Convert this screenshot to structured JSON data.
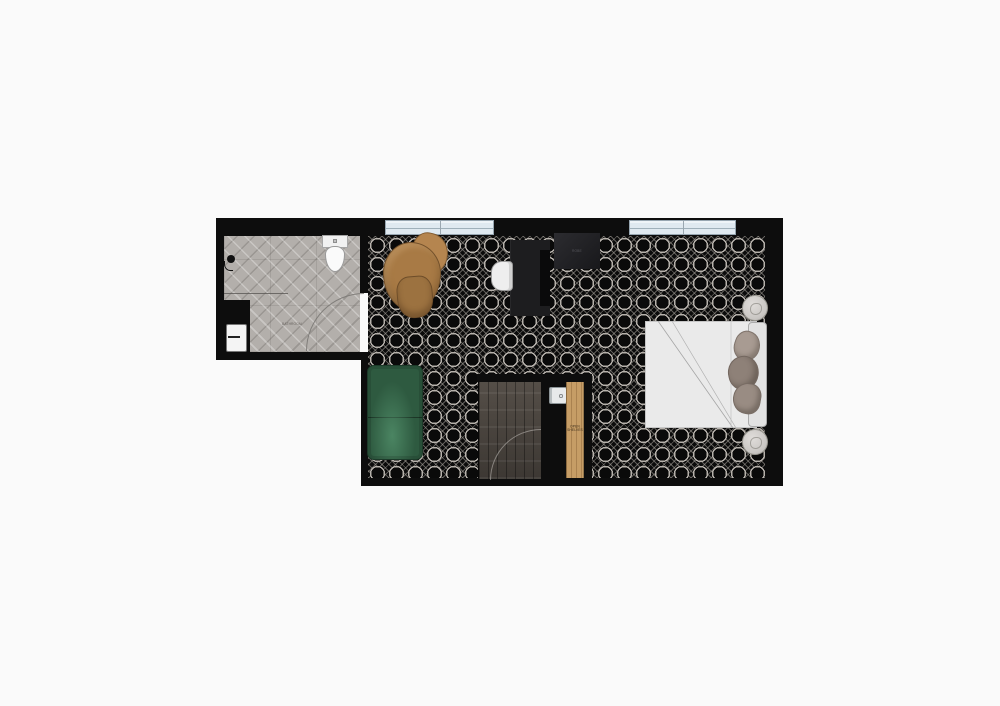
{
  "document": {
    "type": "floor-plan",
    "subject": "studio apartment top-down plan"
  },
  "labels": {
    "bathroom": "BATHROOM",
    "wardrobe": "ROBE",
    "open_shelves": "OPEN SHELVES"
  },
  "rooms": [
    {
      "name": "bathroom",
      "floor": "herringbone-tile"
    },
    {
      "name": "main-room",
      "floor": "cane-weave-pattern"
    },
    {
      "name": "entry-closet",
      "floor": "dark-wood-plank"
    }
  ],
  "furniture": [
    "toilet",
    "vanity-sink",
    "shower-head",
    "shower-glass-panel",
    "lounge-chair",
    "desk",
    "desk-chair",
    "wardrobe-box",
    "green-sofa",
    "bed",
    "headboard",
    "pillows",
    "side-stool-top",
    "side-stool-bottom",
    "appliance",
    "open-shelves-panel",
    "door-swing-bathroom",
    "door-swing-entry",
    "window-left",
    "window-right"
  ],
  "colors": {
    "background": "#fafafa",
    "wall": "#0d0d0d",
    "cane_floor_base": "#0b0b0b",
    "cane_weave": "#b6b1ab",
    "bathroom_tile": "#b3afab",
    "window_glass": "#dfe9f0",
    "sofa_green": "#2e5a40",
    "sofa_green_highlight": "#5c9a72",
    "lounge_chair_wood": "#a87a45",
    "desk": "#1d1d1f",
    "bed_linen": "#eaeaea",
    "pillow_taupe": "#998c83",
    "closet_wood_floor": "#4c4640",
    "shelf_wood": "#c69d66",
    "steel_appliance": "#e8eaeb"
  }
}
